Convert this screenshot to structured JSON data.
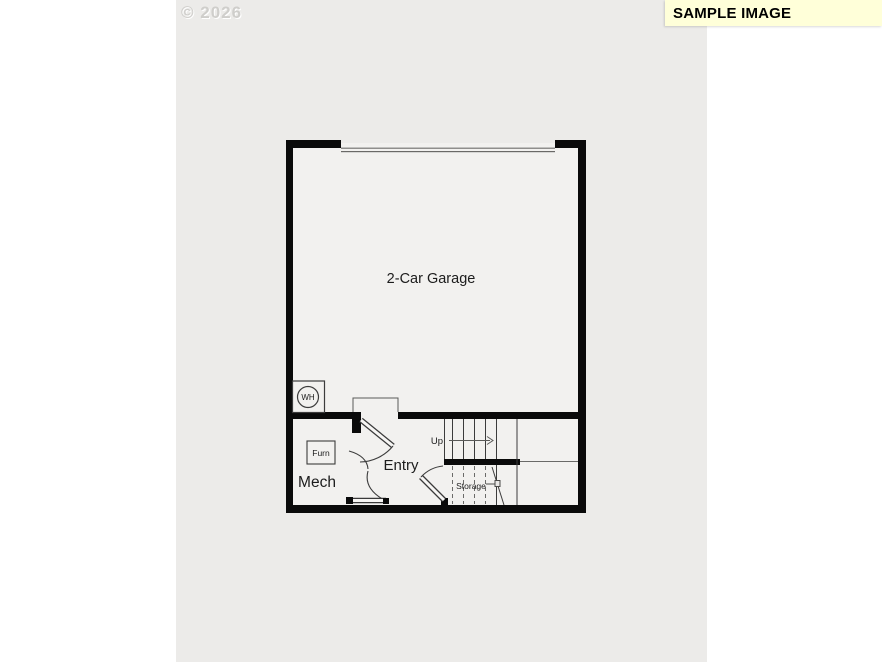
{
  "watermark": {
    "text": "© 2026"
  },
  "banner": {
    "label": "SAMPLE IMAGE",
    "bg_color": "#FFFFD9"
  },
  "floorplan": {
    "labels": {
      "garage": "2-Car Garage",
      "entry": "Entry",
      "mech": "Mech",
      "storage": "Storage",
      "up": "Up",
      "furnace": "Furn",
      "water_heater": "WH"
    },
    "colors": {
      "canvas": "#ECEBE9",
      "interior": "#F2F1EF",
      "wall": "#0A0A0A"
    }
  }
}
